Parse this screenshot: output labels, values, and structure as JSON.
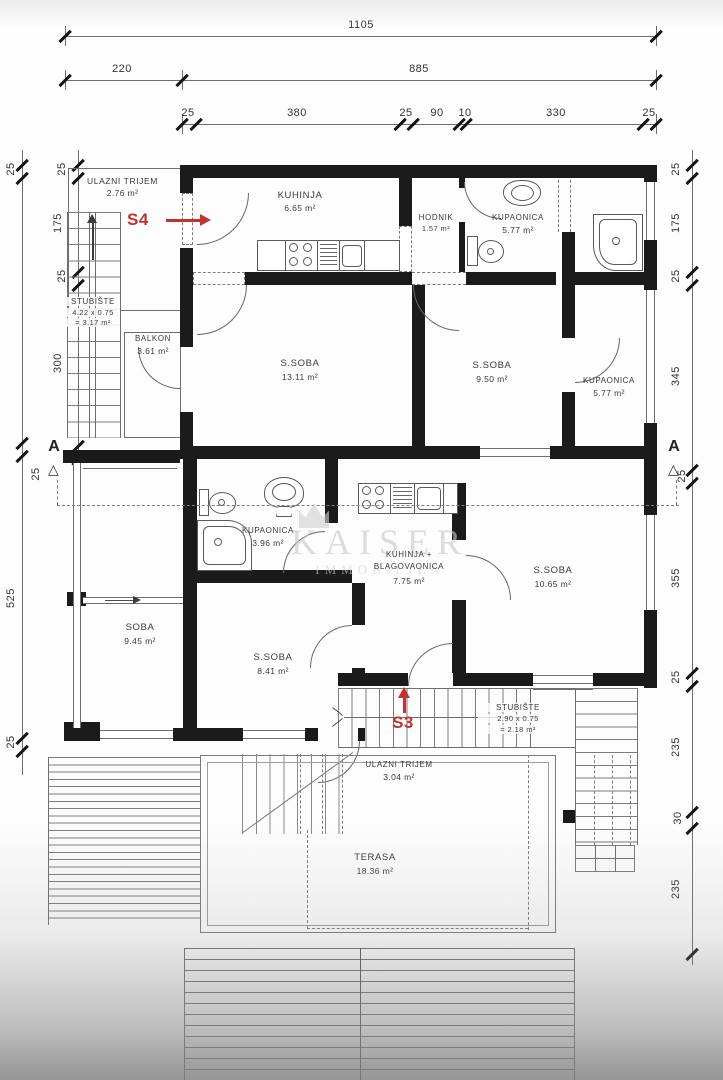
{
  "plan": {
    "dims": {
      "top1": "1105",
      "top2": [
        "220",
        "885"
      ],
      "top3": [
        "25",
        "380",
        "25",
        "90",
        "10",
        "330",
        "25"
      ],
      "left_outer": [
        "25",
        "525",
        "25"
      ],
      "left_inner": [
        "25",
        "175",
        "25",
        "300",
        "25"
      ],
      "right": [
        "25",
        "175",
        "25",
        "345",
        "25",
        "355",
        "25",
        "235",
        "30",
        "235"
      ]
    },
    "rooms": [
      {
        "name": "ULAZNI TRIJEM",
        "area": "2.76 m²"
      },
      {
        "name": "KUHINJA",
        "area": "6.65 m²"
      },
      {
        "name": "HODNIK",
        "area": "1.57 m²"
      },
      {
        "name": "KUPAONICA",
        "area": "5.77 m²"
      },
      {
        "name": "S.SOBA",
        "area": "13.11 m²"
      },
      {
        "name": "S.SOBA",
        "area": "9.50 m²"
      },
      {
        "name": "KUPAONICA",
        "area": "5.77 m²"
      },
      {
        "name": "BALKON",
        "area": "3.61 m²"
      },
      {
        "name": "KUPAONICA",
        "area": "3.96 m²"
      },
      {
        "name": "KUHINJA +",
        "name2": "BLAGOVAONICA",
        "area": "7.75 m²"
      },
      {
        "name": "S.SOBA",
        "area": "10.65 m²"
      },
      {
        "name": "SOBA",
        "area": "9.45 m²"
      },
      {
        "name": "S.SOBA",
        "area": "8.41 m²"
      },
      {
        "name": "ULAZNI TRIJEM",
        "area": "3.04 m²"
      },
      {
        "name": "TERASA",
        "area": "18.36 m²"
      }
    ],
    "stairs": [
      {
        "name": "STUBIŠTE",
        "calc": "4.22 x 0.75",
        "result": "= 3.17 m²"
      },
      {
        "name": "STUBIŠTE",
        "calc": "2.90 x 0.75",
        "result": "= 2.18 m²"
      }
    ],
    "markers": {
      "s4": "S4",
      "s3": "S3",
      "section": "A"
    },
    "watermark": {
      "line1": "KAISER",
      "line2": "IMMOBILIEN"
    },
    "colors": {
      "wall": "#1b1b1b",
      "line": "#6e6e6e",
      "red": "#c0342e"
    }
  }
}
